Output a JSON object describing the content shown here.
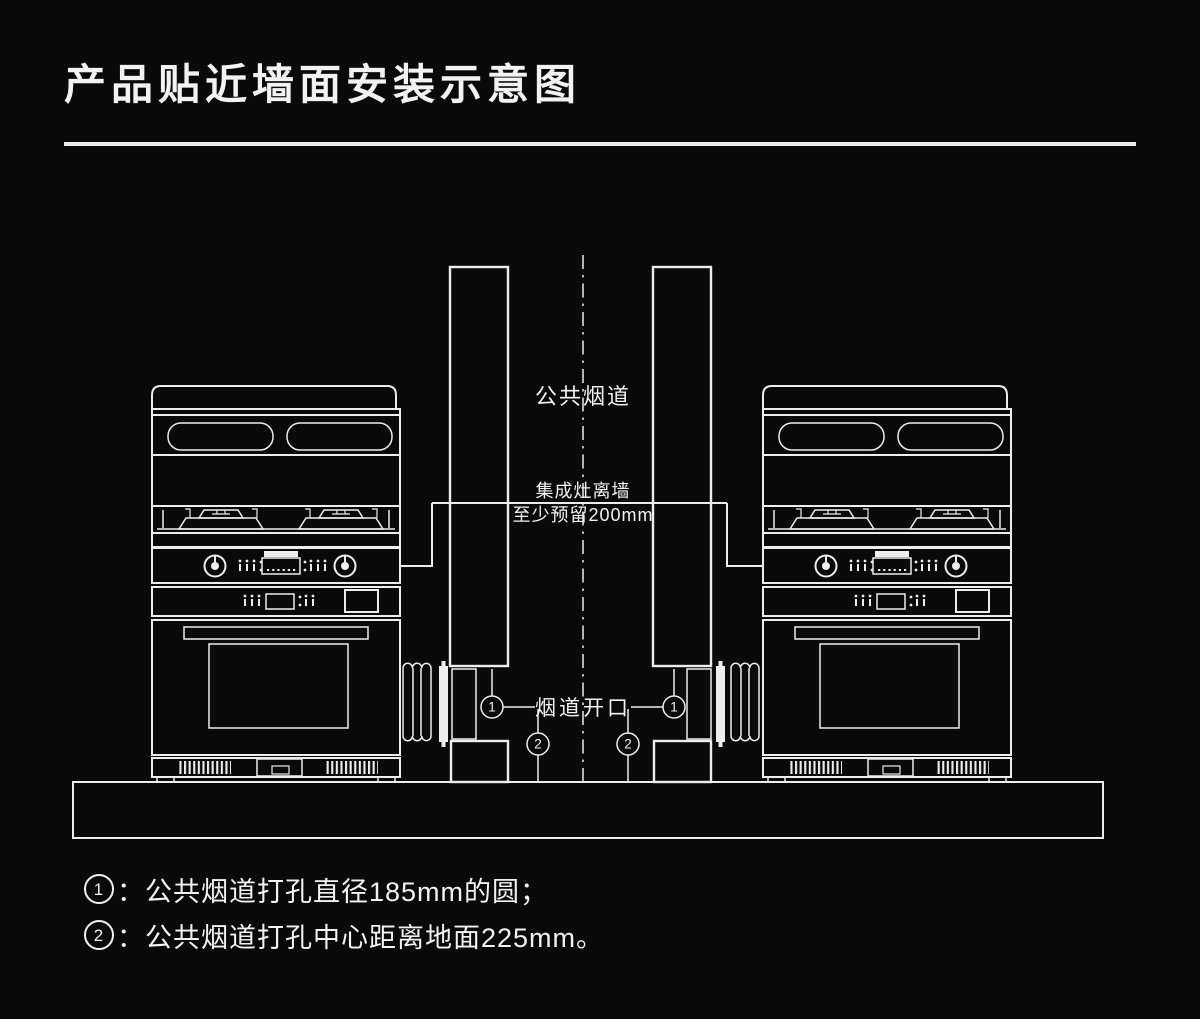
{
  "header": {
    "title": "产品贴近墙面安装示意图"
  },
  "colors": {
    "background": "#0a0a0a",
    "line": "#ededed",
    "text": "#f2f2f2"
  },
  "diagram": {
    "flue_label": "公共烟道",
    "clearance_label_line1": "集成灶离墙",
    "clearance_label_line2": "至少预留200mm",
    "opening_label": "烟道开口",
    "markers": {
      "hole_diameter": "1",
      "hole_height": "2"
    }
  },
  "notes": [
    {
      "marker": "1",
      "text": "：公共烟道打孔直径185mm的圆；"
    },
    {
      "marker": "2",
      "text": "：公共烟道打孔中心距离地面225mm。"
    }
  ]
}
